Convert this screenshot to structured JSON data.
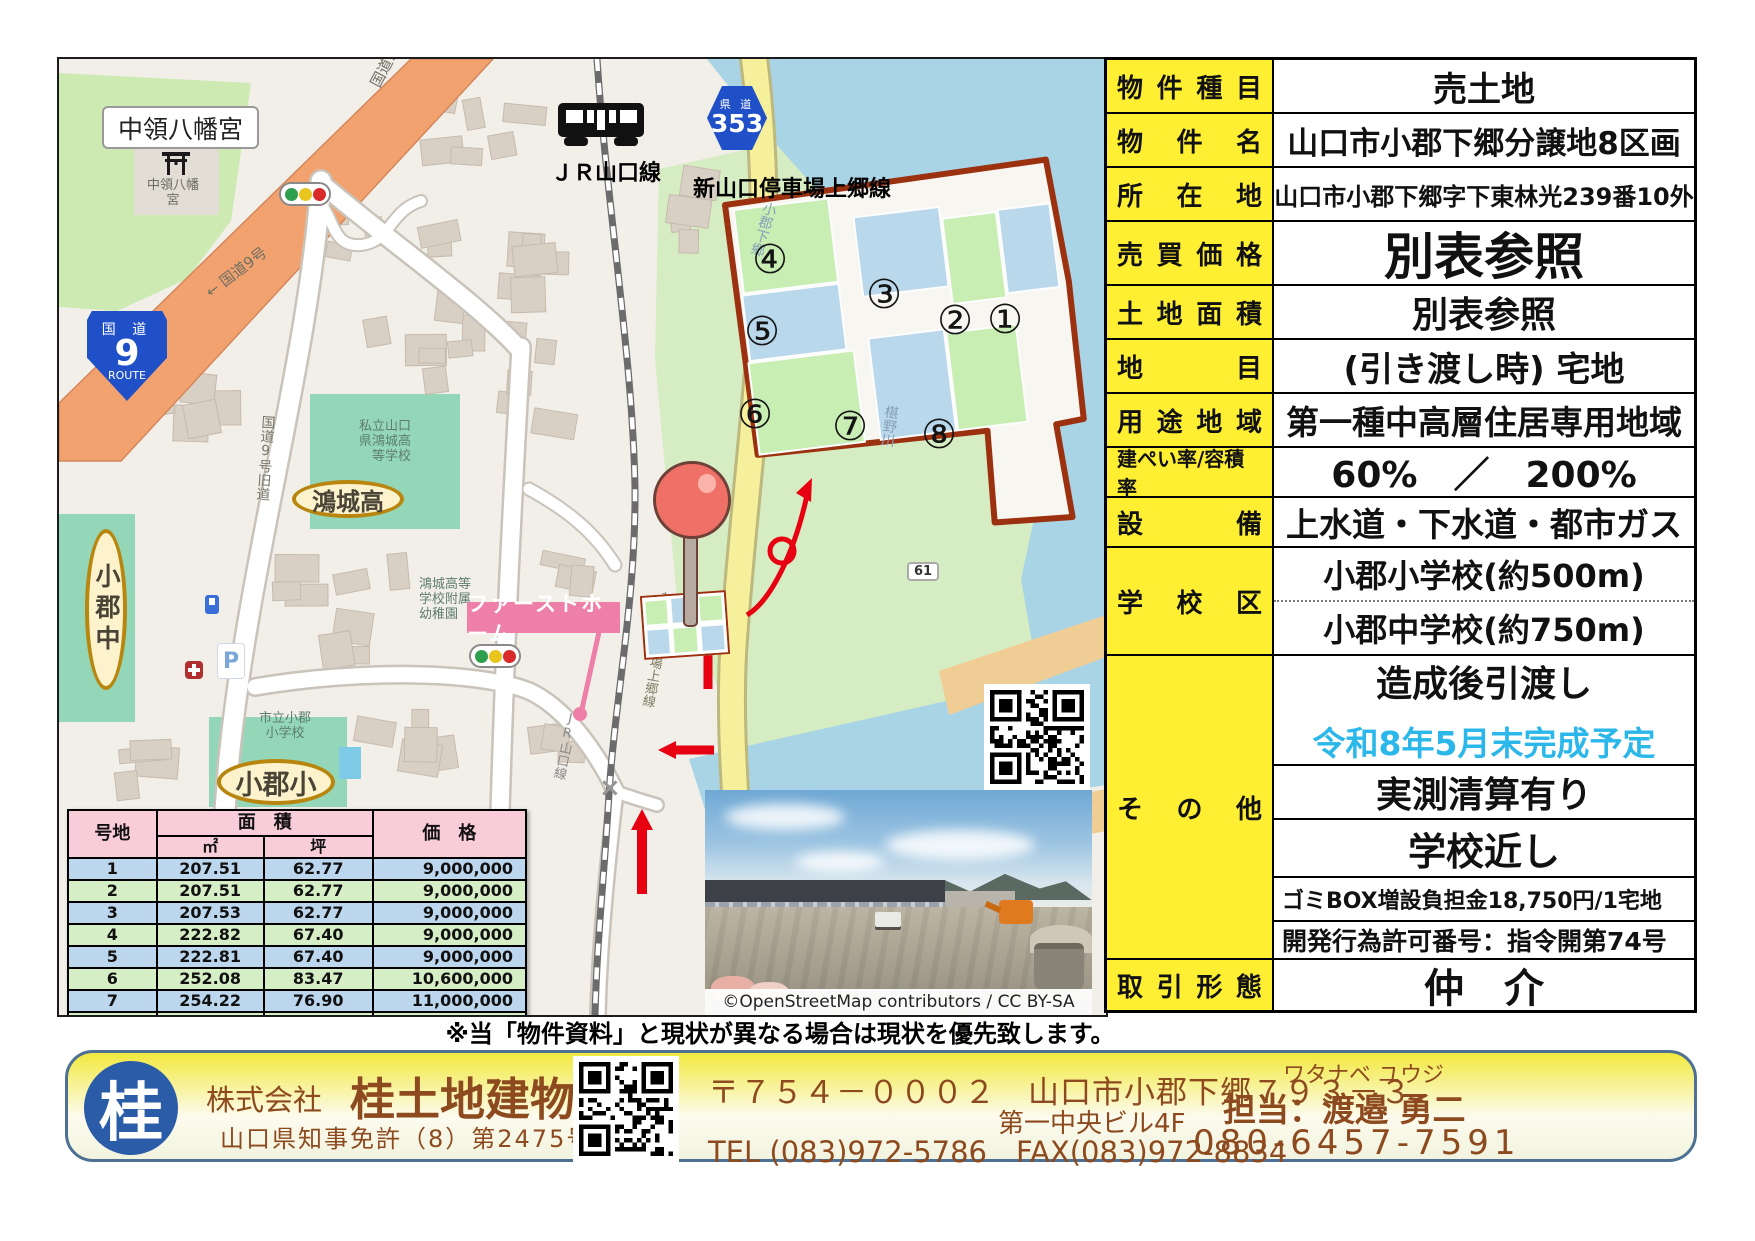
{
  "map": {
    "labels": {
      "hachimangu_box": "中領八幡宮",
      "hachimangu_map_1": "中領八幡",
      "hachimangu_map_2": "宮",
      "route9_top": "国 道",
      "route9_num": "9",
      "route9_bottom": "ROUTE",
      "kokudo9": "国道9号",
      "kokudo9_arrow": "← 国道9号",
      "kokudo9_old": "国道9号旧道",
      "jr_line_bold": "ＪＲ山口線",
      "jr_line_small": "JR山口線",
      "kendo_small": "県 道",
      "kendo_num": "353",
      "teishajo": "新山口停車場上郷線",
      "teishajo_small": "新山口停車場上郷線",
      "ogori_shimogo": "小郡下郷",
      "fushino_river": "椹野川",
      "route61": "61",
      "kojo_school_1": "私立山口",
      "kojo_school_2": "県鴻城高",
      "kojo_school_3": "等学校",
      "kojo_oval": "鴻城高",
      "ogori_jhs": "小郡中",
      "ogori_es": "小郡小",
      "yochien_1": "鴻城高等",
      "yochien_2": "学校附属",
      "yochien_3": "幼稚園",
      "city_es_1": "市立小郡",
      "city_es_2": "小学校",
      "first_home": "ファーストホーム",
      "parking": "P",
      "crossing": "×",
      "osm_credit": "©OpenStreetMap contributors / CC BY-SA"
    },
    "plots": [
      "①",
      "②",
      "③",
      "④",
      "⑤",
      "⑥",
      "⑦",
      "⑧"
    ]
  },
  "price_table": {
    "headers": {
      "lot": "号地",
      "area": "面　積",
      "sqm": "㎡",
      "tsubo": "坪",
      "price": "価　格"
    },
    "rows": [
      {
        "lot": "1",
        "sqm": "207.51",
        "tsubo": "62.77",
        "price": "9,000,000"
      },
      {
        "lot": "2",
        "sqm": "207.51",
        "tsubo": "62.77",
        "price": "9,000,000"
      },
      {
        "lot": "3",
        "sqm": "207.53",
        "tsubo": "62.77",
        "price": "9,000,000"
      },
      {
        "lot": "4",
        "sqm": "222.82",
        "tsubo": "67.40",
        "price": "9,000,000"
      },
      {
        "lot": "5",
        "sqm": "222.81",
        "tsubo": "67.40",
        "price": "9,000,000"
      },
      {
        "lot": "6",
        "sqm": "252.08",
        "tsubo": "83.47",
        "price": "10,600,000"
      },
      {
        "lot": "7",
        "sqm": "254.22",
        "tsubo": "76.90",
        "price": "11,000,000"
      },
      {
        "lot": "8",
        "sqm": "358.34",
        "tsubo": "86.57",
        "price": "12,300,000"
      }
    ]
  },
  "info": {
    "rows": [
      {
        "label": "物件種目",
        "value": "売土地"
      },
      {
        "label": "物件名",
        "value": "山口市小郡下郷分譲地8区画"
      },
      {
        "label": "所在地",
        "value": "山口市小郡下郷字下東林光239番10外"
      },
      {
        "label": "売買価格",
        "value": "別表参照"
      },
      {
        "label": "土地面積",
        "value": "別表参照"
      },
      {
        "label": "地目",
        "value": "(引き渡し時) 宅地"
      },
      {
        "label": "用途地域",
        "value": "第一種中高層住居専用地域"
      },
      {
        "label": "建ぺい率/容積率",
        "value": "60%　／　200%"
      },
      {
        "label": "設備",
        "value": "上水道・下水道・都市ガス"
      },
      {
        "label": "学校区",
        "value1": "小郡小学校(約500m)",
        "value2": "小郡中学校(約750m)"
      },
      {
        "label": "その他",
        "v1": "造成後引渡し",
        "v2": "令和8年5月末完成予定",
        "v3": "実測清算有り",
        "v4": "学校近し",
        "v5": "ゴミBOX増設負担金18,750円/1宅地",
        "v6": "開発行為許可番号：指令開第74号"
      },
      {
        "label": "取引形態",
        "value": "仲　介"
      }
    ]
  },
  "disclaimer": "※当「物件資料」と現状が異なる場合は現状を優先致します。",
  "footer": {
    "logo": "桂",
    "company_prefix": "株式会社",
    "company_name": "桂土地建物",
    "license": "山口県知事免許（8）第2475号",
    "postal": "〒７５４－０００２　山口市小郡下郷７９３－３",
    "building": "第一中央ビル4F",
    "tel": "TEL (083)972-5786　FAX(083)972-8834",
    "furigana": "ワタナベ ユウジ",
    "contact": "担当：渡邉 勇二",
    "mobile": "080-6457-7591"
  },
  "colors": {
    "accent_yellow": "#FFEF33",
    "cyan_text": "#2BB7E9",
    "plot_blue": "#B9D8EC",
    "plot_green": "#C9EEB4",
    "plot_border": "#9C3110",
    "arrow_red": "#E60012",
    "pin_red": "#EF7066",
    "brand_brown": "#8D4A1E",
    "logo_blue": "#2B5CA8",
    "header_pink": "#F8CCD8",
    "row_blue": "#BCD6EE",
    "row_green": "#D6EEC6"
  }
}
